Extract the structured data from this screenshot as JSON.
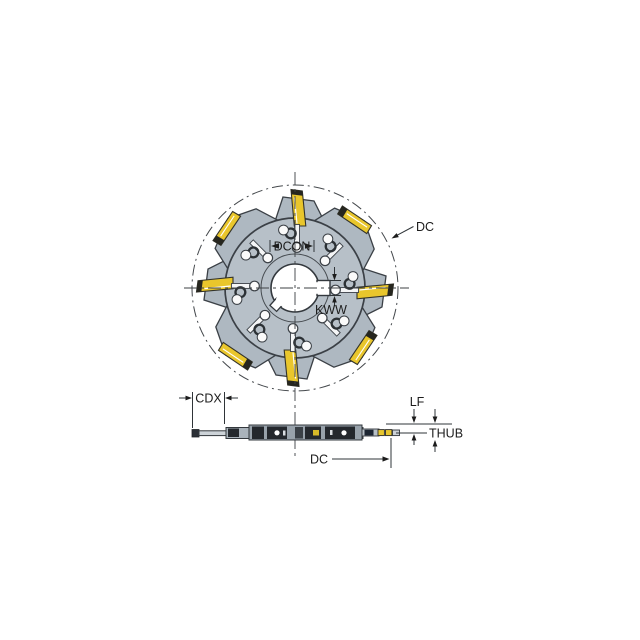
{
  "figure": {
    "description": "Technical dimension drawing of an eight-tooth side and face milling cutter with indexable yellow inserts, shown in front view (top) and edge-on side view (bottom)",
    "front_view": {
      "teeth_count": 8,
      "labels": {
        "dc": "DC",
        "dcon": "DCON",
        "kww": "KWW"
      }
    },
    "side_view": {
      "labels": {
        "cdx": "CDX",
        "lf": "LF",
        "thub": "THUB",
        "dc": "DC"
      }
    }
  },
  "colors": {
    "background": "#ffffff",
    "body_gray": "#b7c0c8",
    "tooth_gray": "#aeb8c1",
    "insert_yellow": "#e9c62c",
    "insert_edge_dark": "#26261f",
    "outline": "#3b4046",
    "dark_segment": "#24282d",
    "navy_block": "#1d2633",
    "dimension_text": "#1c1c1c"
  }
}
